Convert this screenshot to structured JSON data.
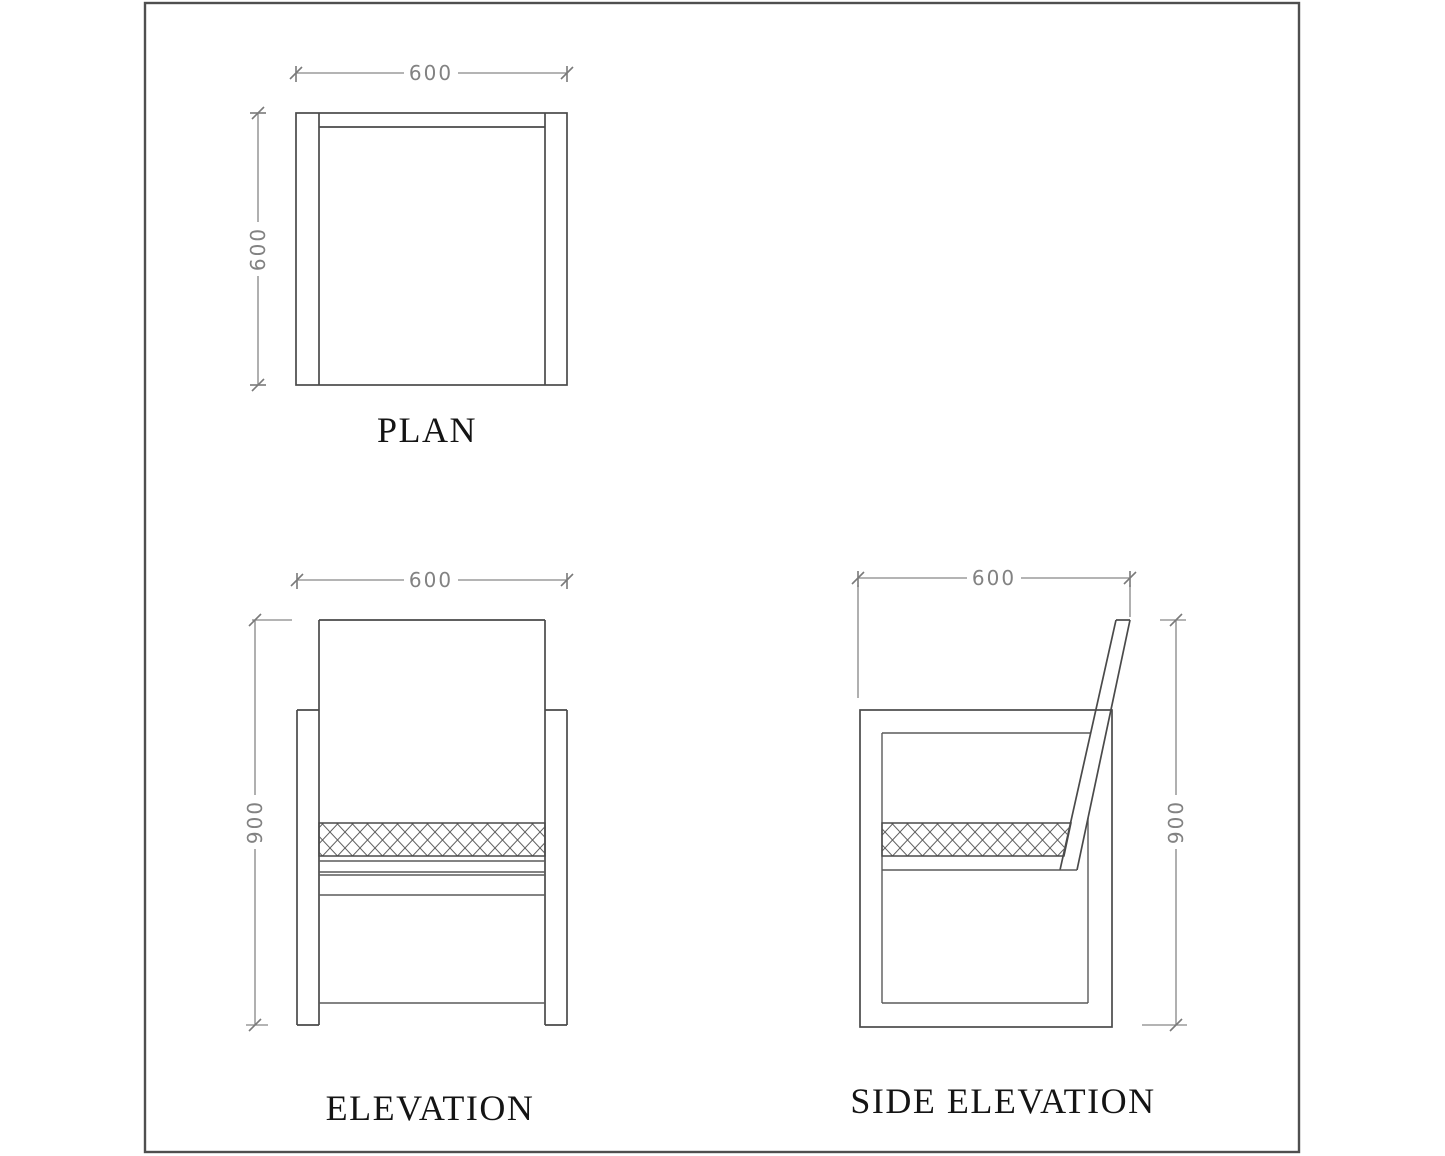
{
  "drawing": {
    "views": [
      {
        "label": "PLAN",
        "width": "600",
        "depth": "600"
      },
      {
        "label": "ELEVATION",
        "width": "600",
        "height": "900"
      },
      {
        "label": "SIDE ELEVATION",
        "depth": "600",
        "height": "900"
      }
    ],
    "colors": {
      "background": "#ffffff",
      "geometry_line": "#4a4a4a",
      "hatch_line": "#606060",
      "dimension_line": "#868686",
      "dimension_text": "#828282",
      "label_text": "#141414",
      "border": "#4f4f4f"
    }
  }
}
